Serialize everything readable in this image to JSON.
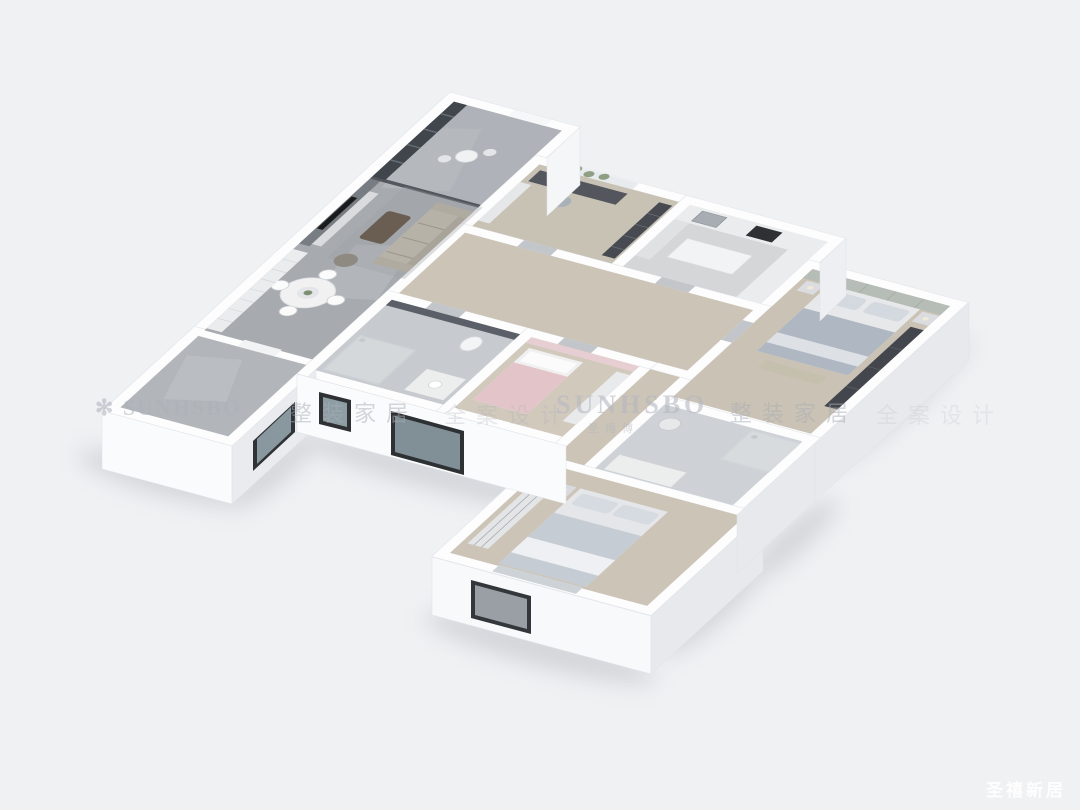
{
  "scene": {
    "type": "3d-isometric-floorplan-render",
    "background_color": "#f0f1f3",
    "wall_color": "#fdfdfe",
    "rooms": [
      {
        "name": "balcony-lounge",
        "features": [
          "dark-glazing",
          "small-round-table",
          "glass-partition"
        ]
      },
      {
        "name": "living-dining-room",
        "floor": "gray-marble",
        "features": [
          "sofa",
          "coffee-table",
          "tv-marble-wall",
          "round-dining-table",
          "white-cabinets"
        ]
      },
      {
        "name": "study",
        "floor": "wood",
        "features": [
          "desk",
          "desk-chair",
          "bookshelf",
          "window-greenery"
        ]
      },
      {
        "name": "kitchen",
        "floor": "tile",
        "features": [
          "l-counter",
          "sink",
          "cooktop",
          "island"
        ]
      },
      {
        "name": "master-bedroom",
        "floor": "wood",
        "features": [
          "double-bed",
          "paneled-headboard-wall",
          "nightstands",
          "dark-wardrobe",
          "bench"
        ]
      },
      {
        "name": "hallway",
        "floor": "wood",
        "features": [
          "doors"
        ]
      },
      {
        "name": "bathroom-1",
        "floor": "tile",
        "features": [
          "dark-tile-wall",
          "glass-shower",
          "toilet",
          "vanity"
        ]
      },
      {
        "name": "kids-room",
        "floor": "wood",
        "features": [
          "pink-accent-wall",
          "single-bed-pink-blanket",
          "wardrobe"
        ]
      },
      {
        "name": "bathroom-2",
        "floor": "tile",
        "features": [
          "glass-shower",
          "vanity",
          "chrome-fixture"
        ]
      },
      {
        "name": "second-bedroom",
        "floor": "wood",
        "features": [
          "double-bed",
          "sliding-wardrobe",
          "nightstand",
          "front-window"
        ]
      },
      {
        "name": "utility-balcony",
        "floor": "gray-marble",
        "features": [
          "empty",
          "front-windows"
        ]
      }
    ],
    "watermark": {
      "logo_glyph": "✻",
      "brand_latin": "SUNHSBO",
      "brand_sub": "圣禧博",
      "phrase_home": "整装家居",
      "phrase_design": "全案设计",
      "corner_text": "圣禧新居",
      "band_color": "#acb1b9",
      "corner_color": "#ffffff"
    }
  }
}
